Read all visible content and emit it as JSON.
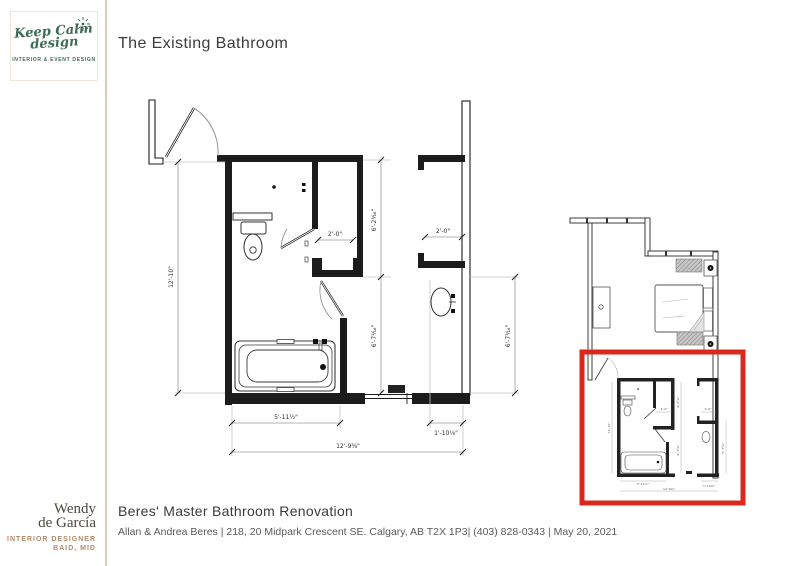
{
  "slide": {
    "title": "The Existing Bathroom",
    "footer": {
      "project_title": "Beres' Master Bathroom Renovation",
      "project_details": "Allan & Andrea Beres | 218, 20  Midpark Crescent SE. Calgary, AB T2X 1P3| (403) 828-0343 | May 20, 2021"
    }
  },
  "branding": {
    "logo_line1": "Keep Calm",
    "logo_line2": "design",
    "logo_tagline": "INTERIOR & EVENT DESIGN",
    "designer_name_line1": "Wendy",
    "designer_name_line2": "de García",
    "designer_title": "INTERIOR DESIGNER",
    "designer_credentials": "BAID, MID",
    "accent_green": "#3e6b53",
    "accent_tan": "#b18a68"
  },
  "floor_plan": {
    "dims": {
      "left_height": "12'-10\"",
      "upper_mid": "6'-2³⁄₁₆\"",
      "lower_mid": "6'-7³⁄₁₆\"",
      "right_lower": "6'-7³⁄₁₆\"",
      "closet_left": "2'-0\"",
      "closet_right": "2'-0\"",
      "tub_width": "5'-11½\"",
      "total_width": "12'-9⅜\"",
      "vanity_width": "1'-10⅛\""
    }
  },
  "overview_plan": {
    "highlight_color": "#d9291c"
  }
}
